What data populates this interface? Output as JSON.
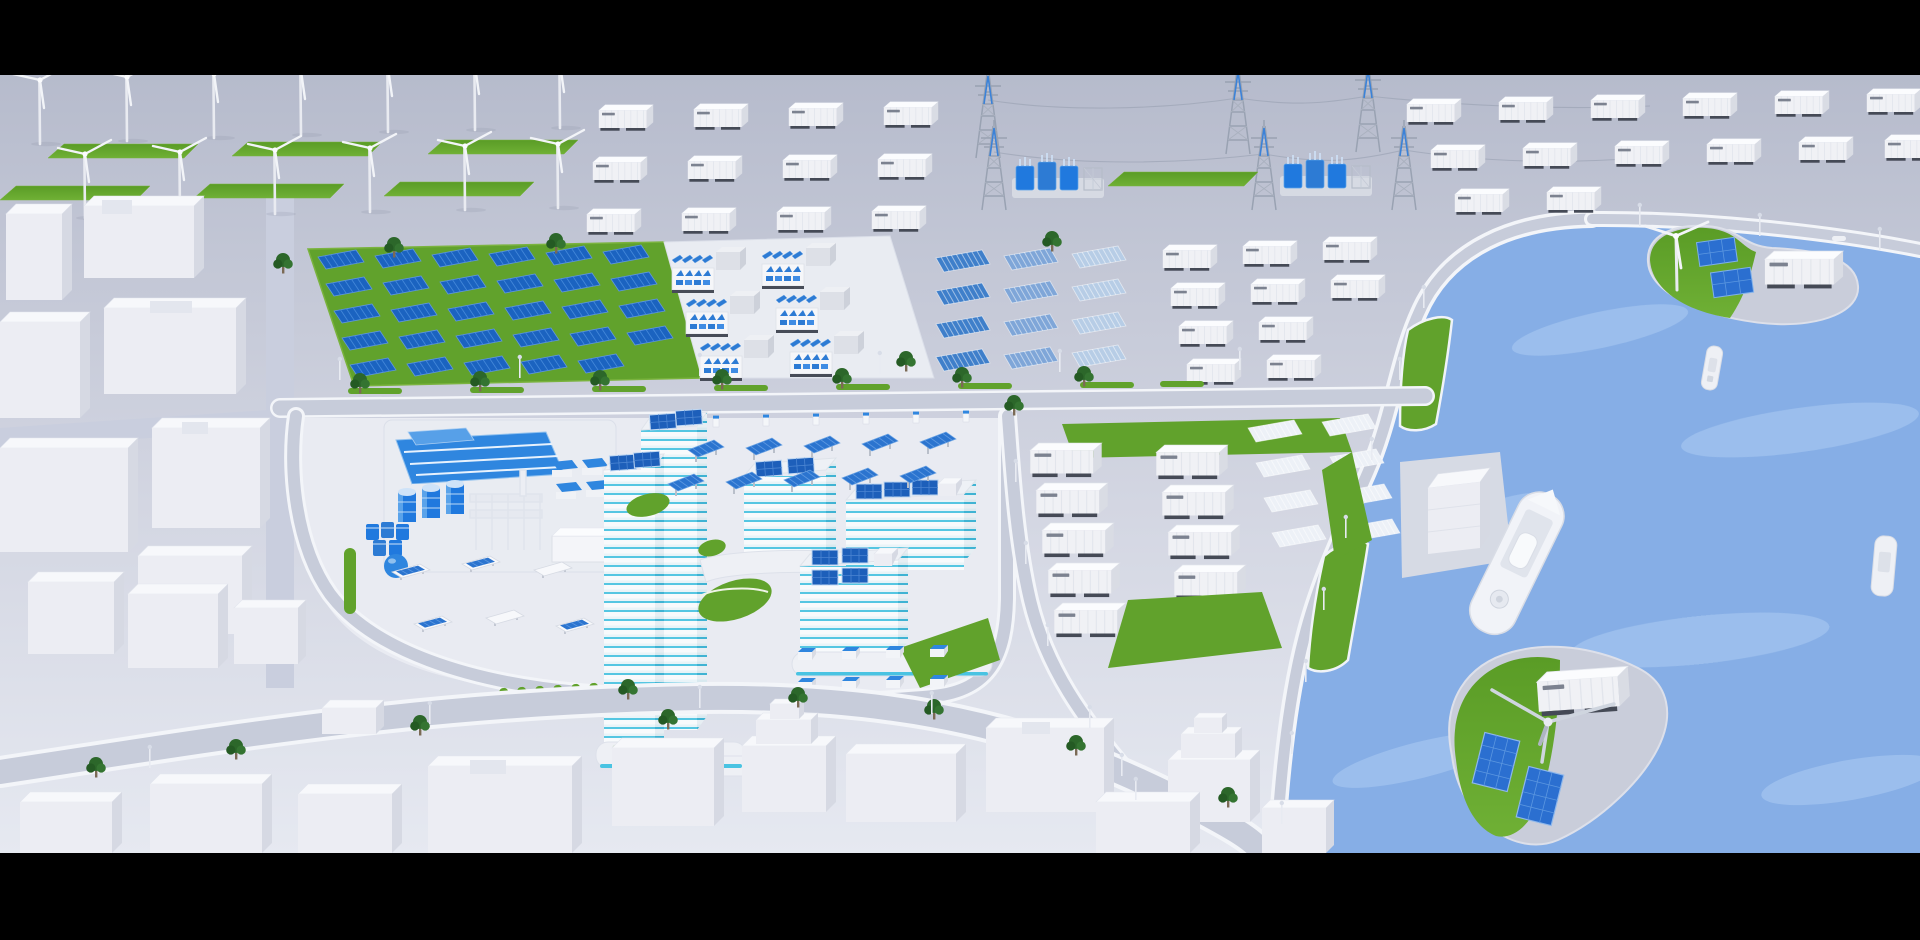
{
  "scene": {
    "type": "3d-render",
    "description": "Aerial isometric 3D render of a clean-energy smart city: wind farm, battery container yards, HV substations, solar farms, office campus with rooftop PV, logistics container yard, harbor with islands, ships and low-poly white city blocks. Letterboxed with black bars.",
    "view": "aerial-isometric",
    "letterbox_top_px": 75,
    "letterbox_bottom_px": 87
  },
  "palette": {
    "letterbox": "#000000",
    "ground_top": "#b6bbcc",
    "ground_bottom": "#e6e9f1",
    "road": "#c7ccda",
    "road_edge": "#f3f5f9",
    "water": "#86aee6",
    "water_light": "#aecdf3",
    "grass": "#61a22c",
    "solar_blue": "#1b63c0",
    "panel_gradient": [
      "#3f7fca",
      "#7fa6d8",
      "#b7cde6",
      "#edf1f7"
    ],
    "accent_cyan": "#49c3e2",
    "tank_blue": "#2079de",
    "transformer_blue": "#2d7bd4",
    "building_white": "#f2f3f7",
    "building_shade": "#d6d9e3",
    "container_white": "#f0f1f5",
    "steel": "#99a2b2",
    "tree_green": "#2c672a",
    "label_mark": "#7c8290"
  },
  "zones": {
    "wind_farm": {
      "label": "onshore wind farm",
      "turbines": 13,
      "grass_strips": 6
    },
    "battery_container_yard_top": {
      "label": "battery storage container rows",
      "containers": 12
    },
    "transmission": {
      "label": "HV transmission corridor",
      "towers": 6,
      "substations": 2
    },
    "container_rows_top_right": {
      "label": "harbor-side storage containers",
      "containers": 14
    },
    "solar_farm": {
      "label": "ground-mounted PV field on grass",
      "panels": 29
    },
    "inverter_skids": {
      "label": "PCS / battery skid clusters",
      "skids": 6
    },
    "gradient_pv_rows": {
      "label": "upright PV rows fading blue to white",
      "rows": 12
    },
    "storage_containers_mid": {
      "label": "storage containers mid-right",
      "containers": 10
    },
    "industrial_plant": {
      "label": "process plant with blue roof, tanks and sphere",
      "tanks": 3,
      "drum_stacks": 5,
      "gas_sphere": 1
    },
    "campus": {
      "label": "smart office campus",
      "striped_towers": 2,
      "mid_rise_buildings": 3,
      "rooftop_pv_arrays": 14,
      "solar_carports": 10,
      "white_carports": 6,
      "ev_chargers": 6,
      "kiosks": 8
    },
    "container_logistics_yard": {
      "label": "logistics container yard",
      "large_containers": 10,
      "white_pv_tables": 8
    },
    "waterfront": {
      "label": "harbor and bay",
      "ships": 4,
      "islands": 2,
      "island_turbines": 2,
      "island_pv_panels": 4,
      "island_containers": 2,
      "quay_buildings": 1
    },
    "city": {
      "label": "low-poly white city blocks",
      "blocks": 26,
      "trees": 22,
      "street_lamps": 27
    }
  },
  "notes": {
    "container_labels": "tiny illegible dark label markings on container sides"
  }
}
